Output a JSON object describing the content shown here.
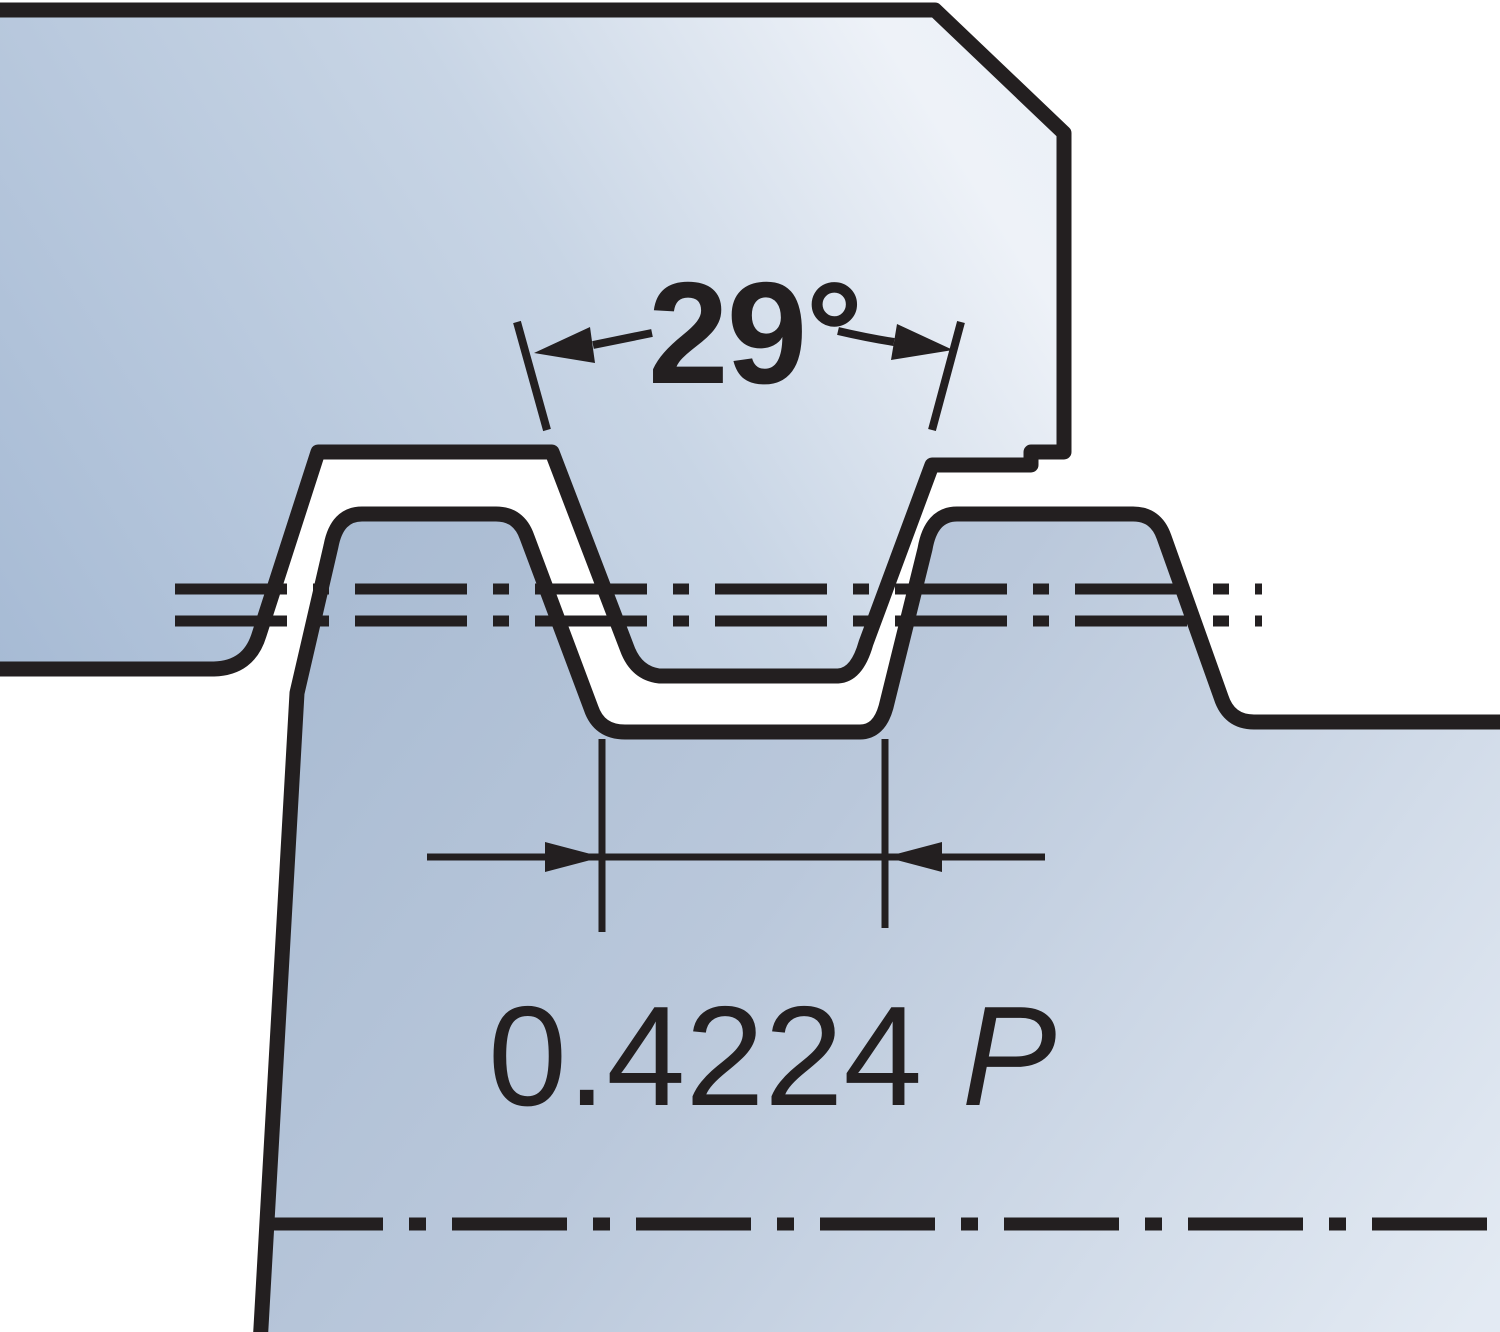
{
  "diagram": {
    "type": "acme-thread-profile-engagement",
    "angle_dimension": {
      "label": "29°"
    },
    "width_dimension": {
      "value": "0.4224",
      "unit": "P",
      "full_label": "0.4224 P"
    },
    "colors": {
      "outline": "#231f20",
      "background": "#ffffff",
      "tool_dark": "#a6bad4",
      "tool_mid": "#c8d5e5",
      "tool_light": "#eef2f8",
      "tool_edge": "#e6edf5",
      "work_dark": "#a6b9d1",
      "work_mid": "#bac8db",
      "work_light": "#e3eaf3"
    }
  }
}
